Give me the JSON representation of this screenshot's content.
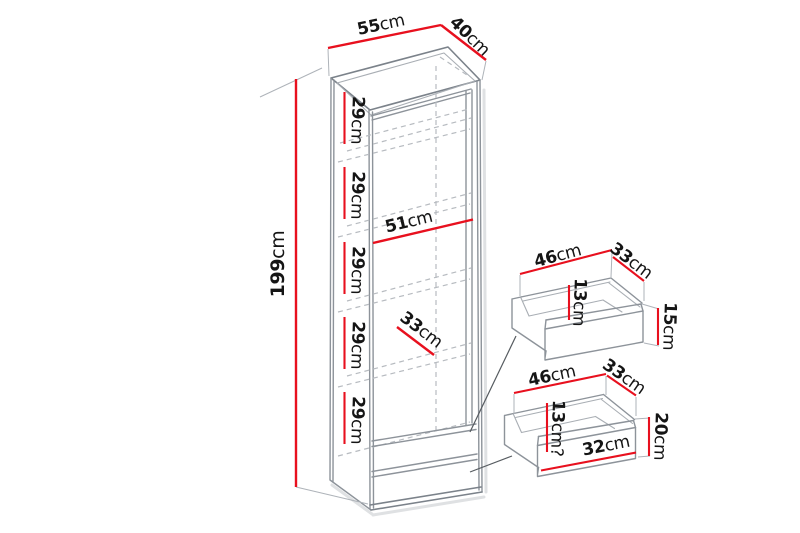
{
  "diagram": {
    "cabinet": {
      "width": {
        "value": "55",
        "unit": "cm"
      },
      "depth": {
        "value": "40",
        "unit": "cm"
      },
      "height": {
        "value": "199",
        "unit": "cm"
      },
      "interior_width": {
        "value": "51",
        "unit": "cm"
      },
      "interior_depth": {
        "value": "33",
        "unit": "cm"
      },
      "shelf_spacings": [
        {
          "value": "29",
          "unit": "cm"
        },
        {
          "value": "29",
          "unit": "cm"
        },
        {
          "value": "29",
          "unit": "cm"
        },
        {
          "value": "29",
          "unit": "cm"
        },
        {
          "value": "29",
          "unit": "cm"
        }
      ]
    },
    "top_drawer": {
      "width": {
        "value": "46",
        "unit": "cm"
      },
      "depth": {
        "value": "33",
        "unit": "cm"
      },
      "inner_depth": {
        "value": "13",
        "unit": "cm"
      },
      "front_height": {
        "value": "15",
        "unit": "cm"
      }
    },
    "bottom_drawer": {
      "width": {
        "value": "46",
        "unit": "cm"
      },
      "depth": {
        "value": "33",
        "unit": "cm"
      },
      "inner_depth": {
        "value": "13",
        "unit": "cm?"
      },
      "inner_width": {
        "value": "32",
        "unit": "cm"
      },
      "front_height": {
        "value": "20",
        "unit": "cm"
      }
    },
    "colors": {
      "dimension_line": "#e8101e",
      "outline": "#8d939a",
      "text": "#151515"
    }
  }
}
